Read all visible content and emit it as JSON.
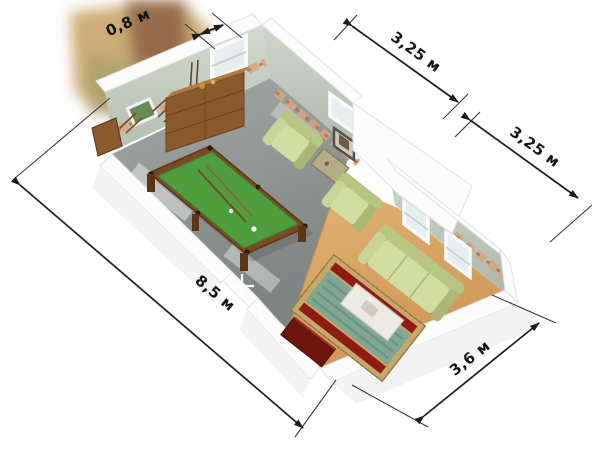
{
  "figure": {
    "type": "isometric-floor-plan",
    "units": "м"
  },
  "dimensions": {
    "wall_niche": {
      "label": "0,8 м",
      "value_m": 0.8
    },
    "facade_bay_1": {
      "label": "3,25 м",
      "value_m": 3.25
    },
    "facade_bay_2": {
      "label": "3,25 м",
      "value_m": 3.25
    },
    "long_side": {
      "label": "8,5 м",
      "value_m": 8.5
    },
    "short_side": {
      "label": "3,6 м",
      "value_m": 3.6
    }
  },
  "room": {
    "areas": [
      "billiard-area",
      "lounge-area"
    ],
    "furniture": [
      "billiard-table",
      "cues",
      "sideboard",
      "armchair-1",
      "armchair-2",
      "side-table",
      "sofa",
      "coffee-table",
      "rug",
      "tv-cabinet",
      "corner-cabinet",
      "cue-rack",
      "wall-picture",
      "windows"
    ],
    "colors": {
      "wall_interior": "#c6d0c3",
      "wall_cut": "#fcfcfc",
      "floor_billiard": "#909595",
      "floor_lounge": "#d6a262",
      "billiard_cloth": "#4f9e3e",
      "billiard_frame": "#7a4a26",
      "seating": "#c9d596",
      "rug_center": "#7fa792",
      "rug_accent": "#8e1c12",
      "frieze": "#d9a47f",
      "dimension_line": "#1c1c1c"
    }
  }
}
